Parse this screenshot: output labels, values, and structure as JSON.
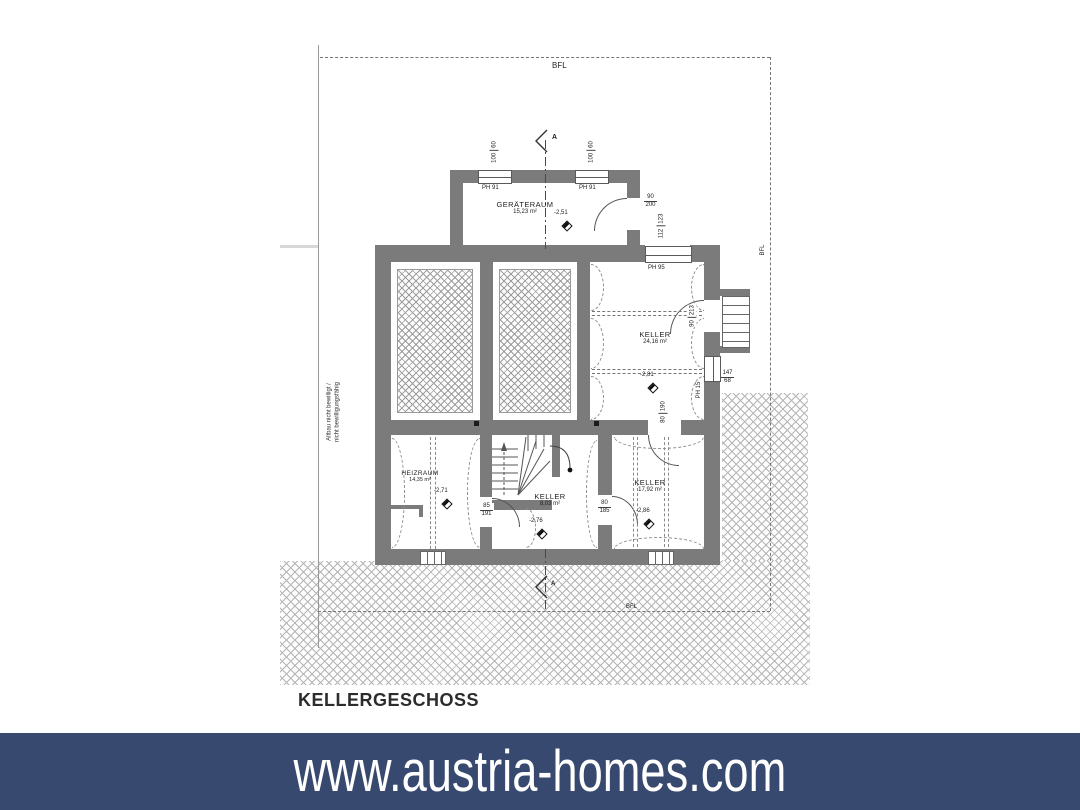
{
  "banner": {
    "text": "www.austria-homes.com",
    "bg_color": "#37496e",
    "text_color": "#ffffff"
  },
  "plan": {
    "title": "KELLERGESCHOSS",
    "bfl": {
      "top": "BFL",
      "right": "BFL",
      "bottom": "BFL"
    },
    "section": {
      "label_top": "A",
      "label_bottom": "A"
    },
    "note": {
      "line1": "Altbau nicht bewilligt /",
      "line2": "nicht bewilligungsfähig"
    },
    "rooms": {
      "geraeteraum": {
        "name": "GERÄTERAUM",
        "area": "15,23 m²",
        "level": "-2,51"
      },
      "keller_nord": {
        "name": "KELLER",
        "area": "24,16 m²",
        "level": "-2,81"
      },
      "heizraum": {
        "name": "HEIZRAUM",
        "area": "14,35 m²",
        "level": "-2,71"
      },
      "keller_mitte": {
        "name": "KELLER",
        "area": "8,03 m²",
        "level": "-2,76"
      },
      "keller_sued": {
        "name": "KELLER",
        "area": "17,92 m²",
        "level": "-2,86"
      }
    },
    "windows": {
      "w1": {
        "w": "100",
        "h": "60",
        "ph": "PH 91"
      },
      "w2": {
        "w": "100",
        "h": "60",
        "ph": "PH 91"
      },
      "w3": {
        "w": "112",
        "h": "123",
        "ph": "PH 95"
      },
      "w4": {
        "ph": "PH 15"
      }
    },
    "doors": {
      "geraeteraum": {
        "w": "90",
        "h": "200"
      },
      "aussentuer": {
        "w": "90",
        "h": "213"
      },
      "keller_sued": {
        "w": "80",
        "h": "190"
      },
      "heizraum": {
        "w": "85",
        "h": "191"
      },
      "keller_mitte": {
        "w": "80",
        "h": "185"
      }
    },
    "dims": {
      "lichtschacht": {
        "w": "147",
        "h": "68"
      }
    },
    "wall_color": "#7b7b7b"
  }
}
